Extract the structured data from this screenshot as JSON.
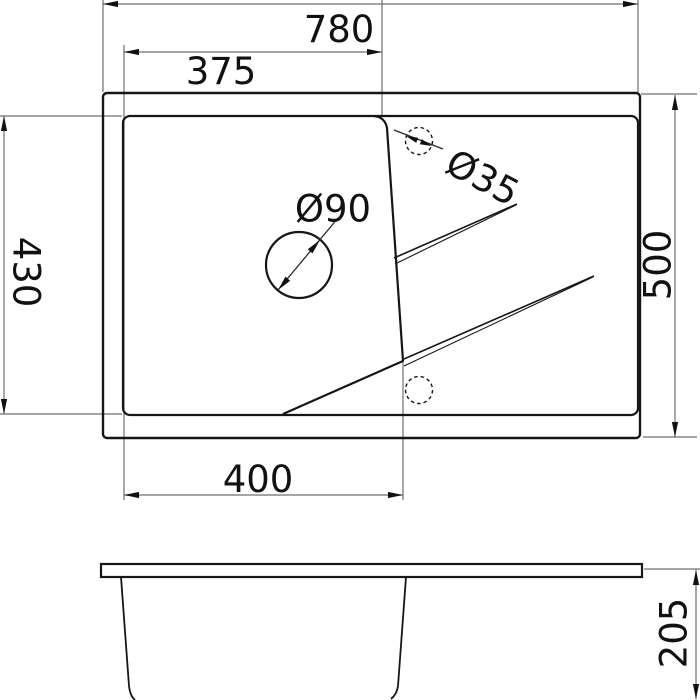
{
  "drawing": {
    "kind": "sink-technical-drawing",
    "views": {
      "top_view": {
        "dimensions": {
          "overall_width": "780",
          "bowl_width_top": "375",
          "bowl_depth": "430",
          "overall_depth": "500",
          "bowl_width_bottom": "400",
          "drain_hole_diameter": "Ø90",
          "tap_hole_diameter": "Ø35"
        }
      },
      "side_view": {
        "dimensions": {
          "bowl_height": "205"
        }
      }
    },
    "colors": {
      "object_line": "#161616",
      "dimension_line": "#6f6f6f",
      "background": "#ffffff"
    }
  }
}
